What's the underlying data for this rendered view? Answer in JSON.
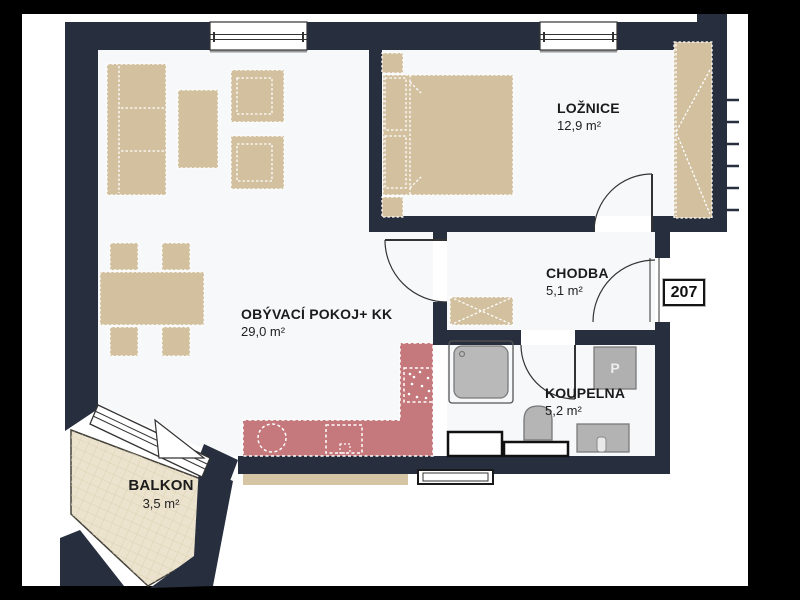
{
  "unit": {
    "number": "207"
  },
  "rooms": {
    "living": {
      "name": "OBÝVACÍ POKOJ+ KK",
      "area": "29,0 m²"
    },
    "bedroom": {
      "name": "LOŽNICE",
      "area": "12,9 m²"
    },
    "hall": {
      "name": "CHODBA",
      "area": "5,1 m²"
    },
    "bathroom": {
      "name": "KOUPELNA",
      "area": "5,2 m²"
    },
    "balcony": {
      "name": "BALKON",
      "area": "3,5 m²"
    }
  },
  "labels": {
    "washer": "P"
  },
  "colors": {
    "wall": "#272f3f",
    "paper": "#ffffff",
    "room_floor": "#f7f8f9",
    "furniture": "#d2c09f",
    "kitchen": "#c5797c",
    "balcony_floor": "#ebe3cd",
    "fixture_gray": "#b5b5b5",
    "line": "#333333"
  }
}
